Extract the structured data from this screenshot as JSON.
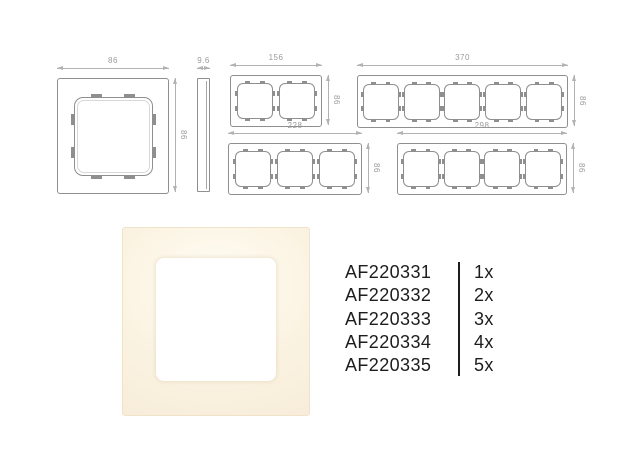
{
  "colors": {
    "drawing_stroke": "#8f8f8f",
    "dimension_line": "#b2b2b2",
    "dimension_text": "#9b9b9b",
    "list_text": "#1d1d1d",
    "product_cream_center": "#fffdf4",
    "product_cream_edge": "#f5ead6",
    "cutout_white": "#ffffff"
  },
  "drawings": {
    "front_1gang": {
      "gangs": 1,
      "width_label": "86",
      "height_label": "86"
    },
    "profile_side": {
      "width_label": "9.6"
    },
    "frame_2gang": {
      "gangs": 2,
      "width_label": "156",
      "height_label": "86"
    },
    "frame_5gang": {
      "gangs": 5,
      "width_label": "370",
      "height_label": "86"
    },
    "frame_3gang": {
      "gangs": 3,
      "width_label": "228",
      "height_label": "86"
    },
    "frame_4gang": {
      "gangs": 4,
      "width_label": "298",
      "height_label": "86"
    }
  },
  "product_list": [
    {
      "sku": "AF220331",
      "qty": "1x"
    },
    {
      "sku": "AF220332",
      "qty": "2x"
    },
    {
      "sku": "AF220333",
      "qty": "3x"
    },
    {
      "sku": "AF220334",
      "qty": "4x"
    },
    {
      "sku": "AF220335",
      "qty": "5x"
    }
  ]
}
